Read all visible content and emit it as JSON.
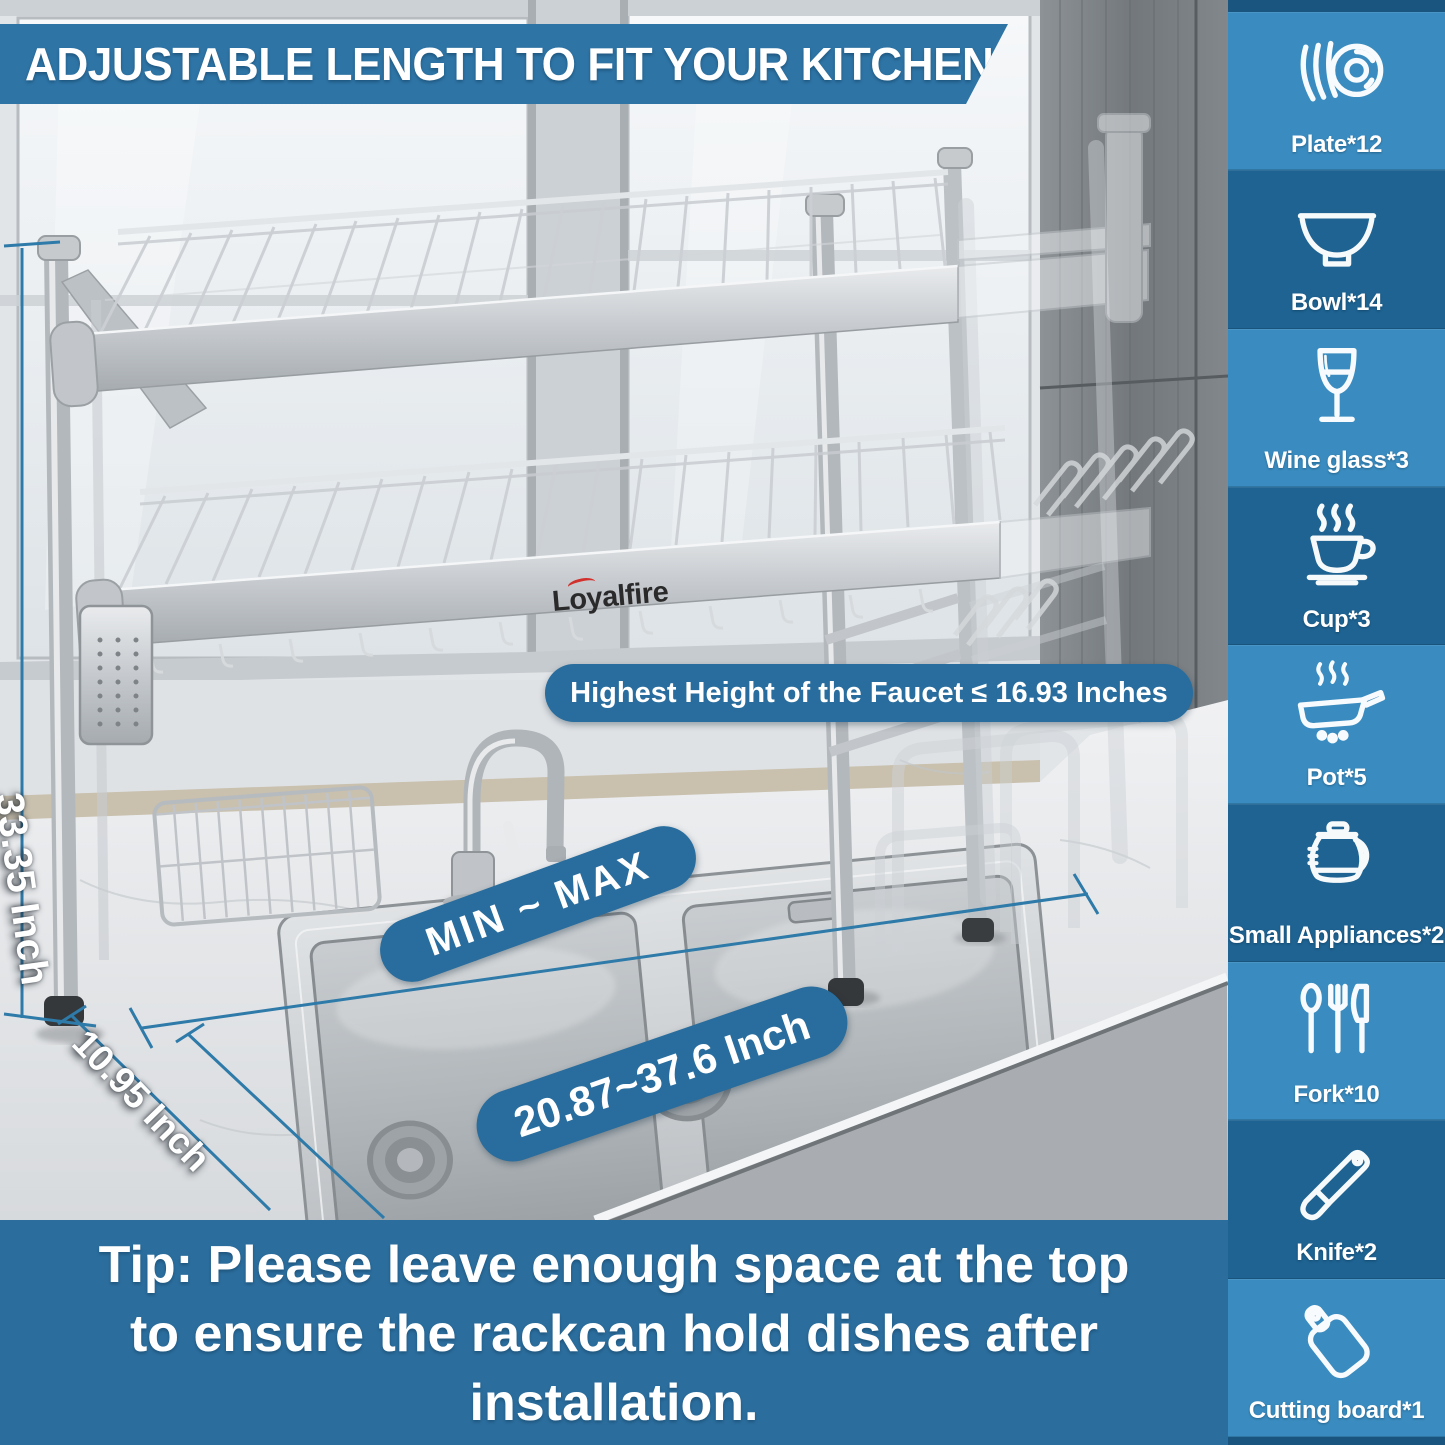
{
  "banner": {
    "title": "ADJUSTABLE LENGTH TO FIT YOUR KITCHEN"
  },
  "photo": {
    "logo": "Loyalfire",
    "faucet_note": "Highest Height of the Faucet ≤ 16.93 Inches",
    "range_label": "MIN ~ MAX",
    "width_range": "20.87~37.6 Inch",
    "height_label": "33.35 Inch",
    "depth_label": "10.95 Inch"
  },
  "tip": {
    "lines": [
      "Tip: Please leave enough space at the top",
      "to ensure the rackcan hold dishes after",
      "installation."
    ]
  },
  "sidebar": {
    "items": [
      {
        "label": "Plate*12",
        "icon": "#icon-plate",
        "icon_name": "plate-icon"
      },
      {
        "label": "Bowl*14",
        "icon": "#icon-bowl",
        "icon_name": "bowl-icon"
      },
      {
        "label": "Wine glass*3",
        "icon": "#icon-wine-glass",
        "icon_name": "wine-glass-icon"
      },
      {
        "label": "Cup*3",
        "icon": "#icon-cup",
        "icon_name": "cup-icon"
      },
      {
        "label": "Pot*5",
        "icon": "#icon-pot",
        "icon_name": "pot-icon"
      },
      {
        "label": "Small Appliances*2",
        "icon": "#icon-small-appliances",
        "icon_name": "small-appliances-icon"
      },
      {
        "label": "Fork*10",
        "icon": "#icon-fork",
        "icon_name": "fork-icon"
      },
      {
        "label": "Knife*2",
        "icon": "#icon-knife",
        "icon_name": "knife-icon"
      },
      {
        "label": "Cutting board*1",
        "icon": "#icon-cutting-board",
        "icon_name": "cutting-board-icon"
      }
    ]
  },
  "colors": {
    "banner": "#2e75a6",
    "pill": "#286d9d",
    "tip": "#2b6e9e",
    "side-light": "#3a8cc0",
    "side-dark": "#1e6392",
    "side-edge": "#1a5580",
    "line": "#2e7aa9",
    "logo-swoosh": "#d2302c"
  }
}
